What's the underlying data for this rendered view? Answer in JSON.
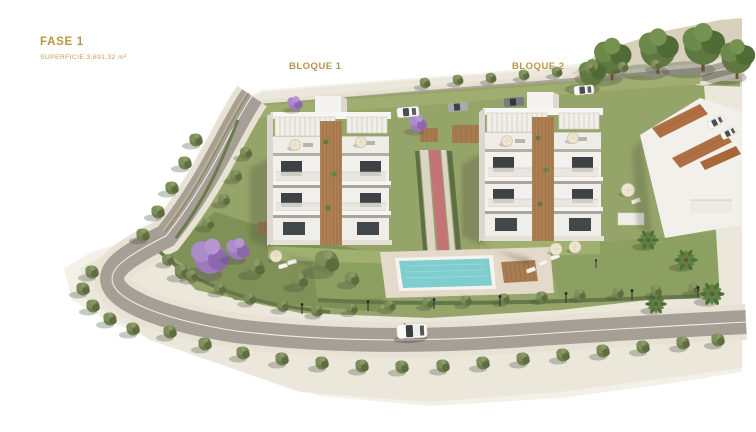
{
  "header": {
    "phase_label": "FASE 1",
    "area_label": "SUPERFICIE 3.691,32 m²"
  },
  "blocks": {
    "block1_label": "BLOQUE 1",
    "block2_label": "BLOQUE 2"
  },
  "palette": {
    "label_gold": "#BA9547",
    "building_white": "#F3F1ED",
    "wood_accent": "#AE8054",
    "pool_water": "#7FCDCE",
    "deck_beige": "#E3DACA",
    "lawn_green": "#95A468",
    "olive_green": "#7D9055",
    "road_gray": "#A69F95",
    "sidewalk_beige": "#E8E2D4",
    "tree_green": "#6F7F4E",
    "jacaranda_purple": "#9C7ABB",
    "terracotta_roof": "#B06F42"
  }
}
